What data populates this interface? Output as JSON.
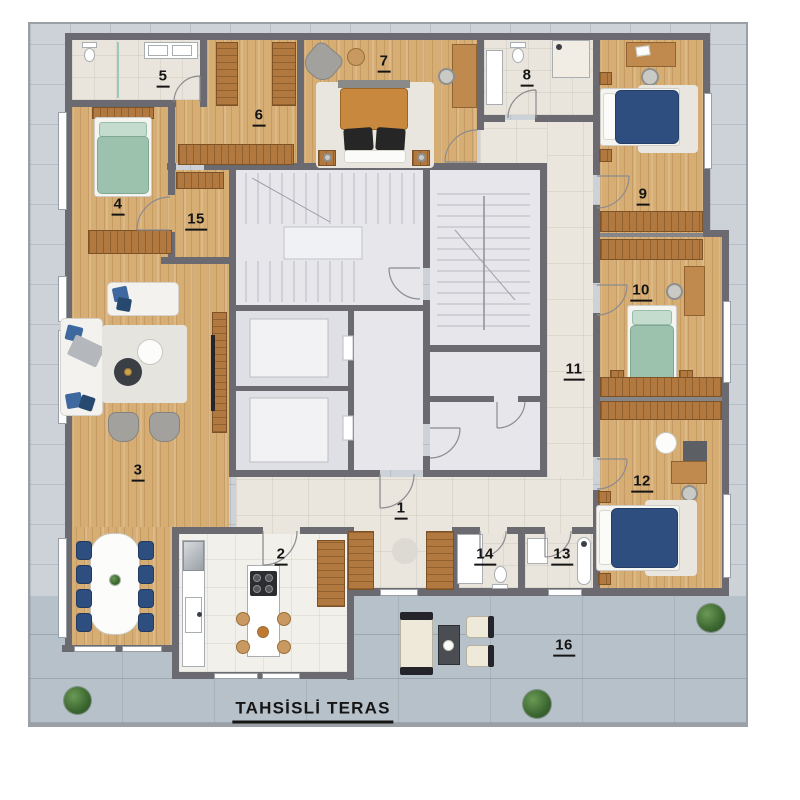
{
  "plan": {
    "title": "TAHSİSLİ TERAS",
    "room_labels": [
      "1",
      "2",
      "3",
      "4",
      "5",
      "6",
      "7",
      "8",
      "9",
      "10",
      "11",
      "12",
      "13",
      "14",
      "15",
      "16"
    ]
  },
  "legend": {
    "colors": {
      "wall": "#6a6a70",
      "wood_floor": "#d6ae74",
      "hall_tile": "#eae6de",
      "bath_tile": "#e9e5dc",
      "kitchen_tile": "#f2f0ea",
      "core_floor": "#e7e7eb",
      "terrace": "#ccd2d7",
      "allocated_terrace": "#b7c1c9",
      "furniture_wood": "#b1793f",
      "bed_navy": "#2f4e80",
      "bed_green": "#9cc2ad",
      "bed_orange": "#c8893f",
      "plant": "#3e6b34"
    }
  }
}
